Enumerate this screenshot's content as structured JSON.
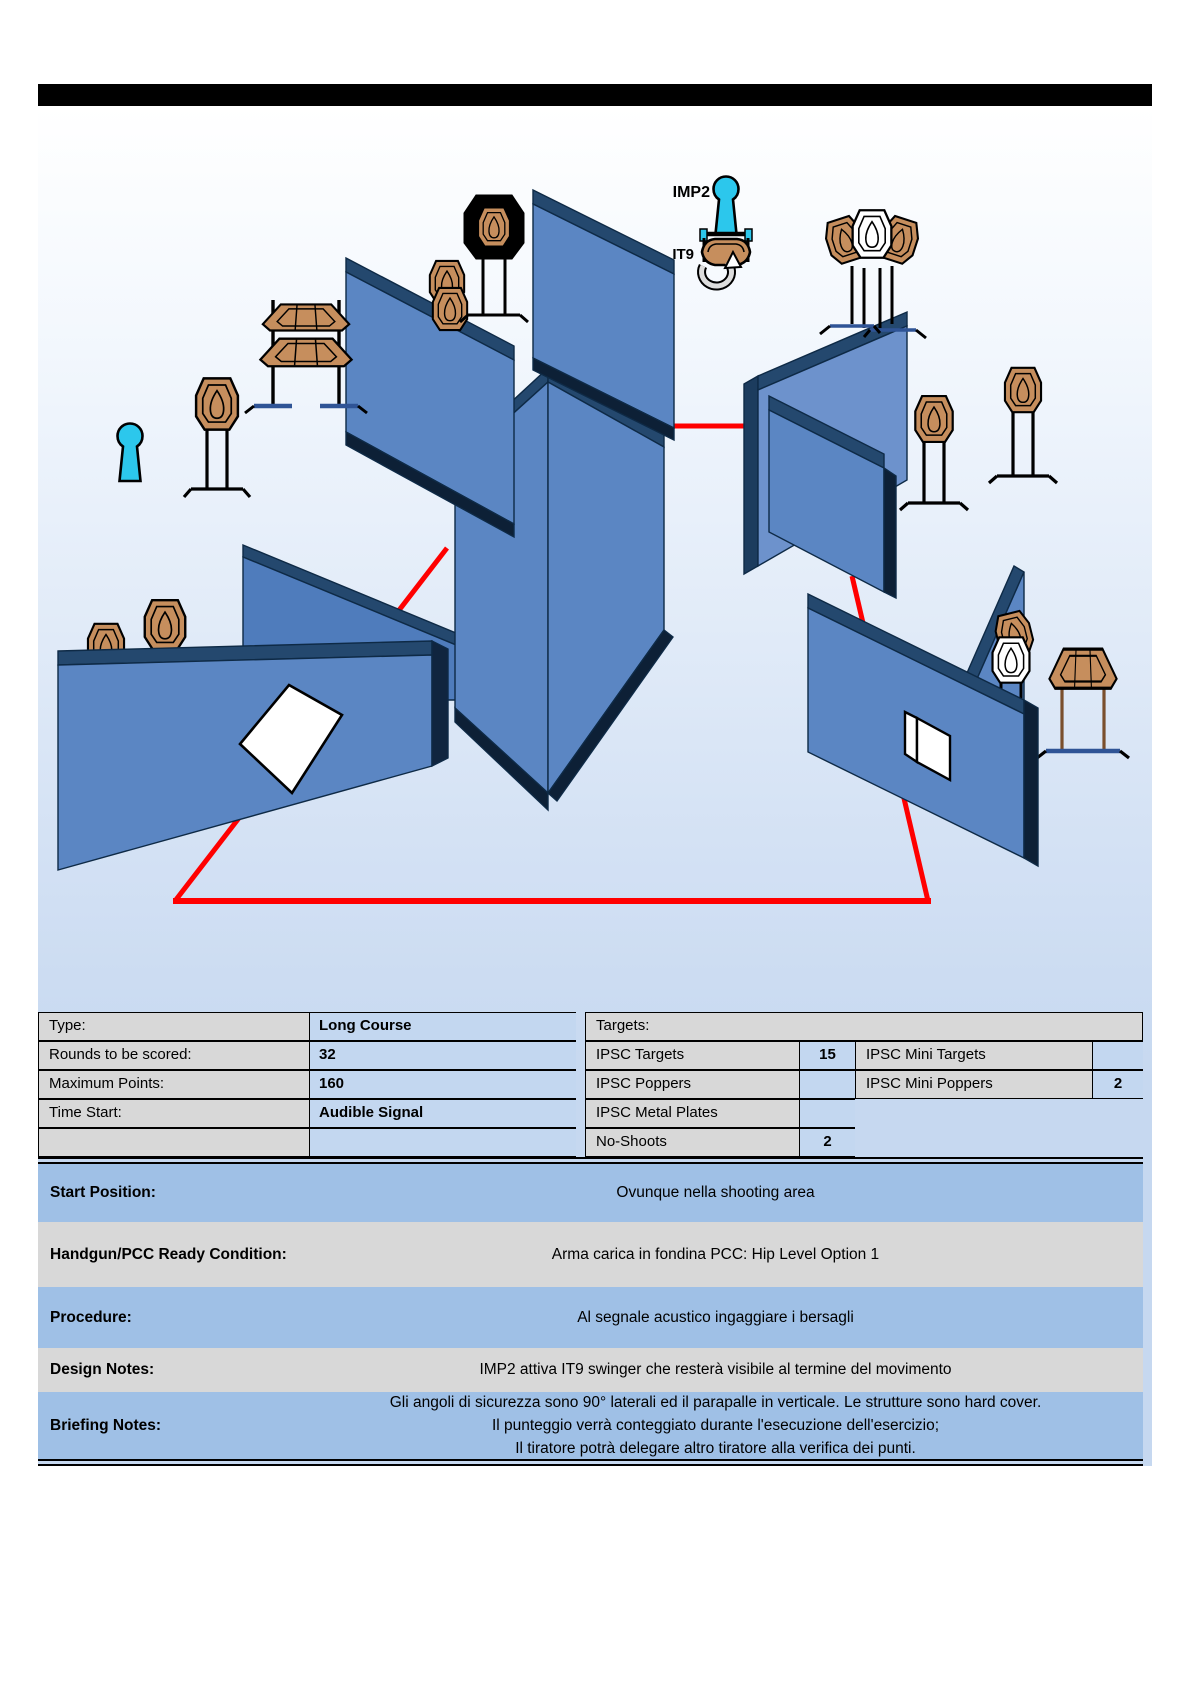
{
  "diagram": {
    "imp2_label": "IMP2",
    "it9_label": "IT9"
  },
  "colors": {
    "wall_blue": "#5b86c3",
    "wall_edge_dark": "#24486e",
    "wall_shadow": "#0d2036",
    "fault_line_red": "#ff0000",
    "target_tan": "#c68e5d",
    "no_shoot_white": "#ffffff",
    "popper_cyan": "#2cc7ec",
    "table_label_gray": "#d8d8d8",
    "table_value_blue": "#c3d7f0",
    "note_row_blue": "#9fc0e6"
  },
  "stage_info": {
    "rows": [
      {
        "label": "Type:",
        "value": "Long Course"
      },
      {
        "label": "Rounds to be scored:",
        "value": "32"
      },
      {
        "label": "Maximum Points:",
        "value": "160"
      },
      {
        "label": "Time Start:",
        "value": "Audible Signal"
      },
      {
        "label": "",
        "value": ""
      }
    ]
  },
  "targets_info": {
    "header": "Targets:",
    "rows": [
      {
        "name": "IPSC Targets",
        "count": "15",
        "name2": "IPSC Mini Targets",
        "count2": ""
      },
      {
        "name": "IPSC Poppers",
        "count": "",
        "name2": "IPSC Mini Poppers",
        "count2": "2"
      },
      {
        "name": "IPSC Metal Plates",
        "count": "",
        "name2": "",
        "count2": ""
      },
      {
        "name": "No-Shoots",
        "count": "2",
        "name2": "",
        "count2": ""
      }
    ]
  },
  "notes": {
    "start_position": {
      "label": "Start Position:",
      "value": "Ovunque nella shooting area"
    },
    "ready_condition": {
      "label": "Handgun/PCC Ready Condition:",
      "value": "Arma carica in fondina PCC: Hip Level Option 1"
    },
    "procedure": {
      "label": "Procedure:",
      "value": "Al segnale acustico ingaggiare i bersagli"
    },
    "design_notes": {
      "label": "Design Notes:",
      "value": "IMP2 attiva IT9 swinger che resterà visibile al termine del movimento"
    },
    "briefing_notes": {
      "label": "Briefing Notes:",
      "lines": [
        "Gli angoli di sicurezza sono 90° laterali ed il parapalle in verticale. Le strutture sono hard cover.",
        "Il punteggio verrà conteggiato durante l'esecuzione dell'esercizio;",
        "Il tiratore potrà delegare altro tiratore alla verifica dei punti."
      ]
    }
  }
}
